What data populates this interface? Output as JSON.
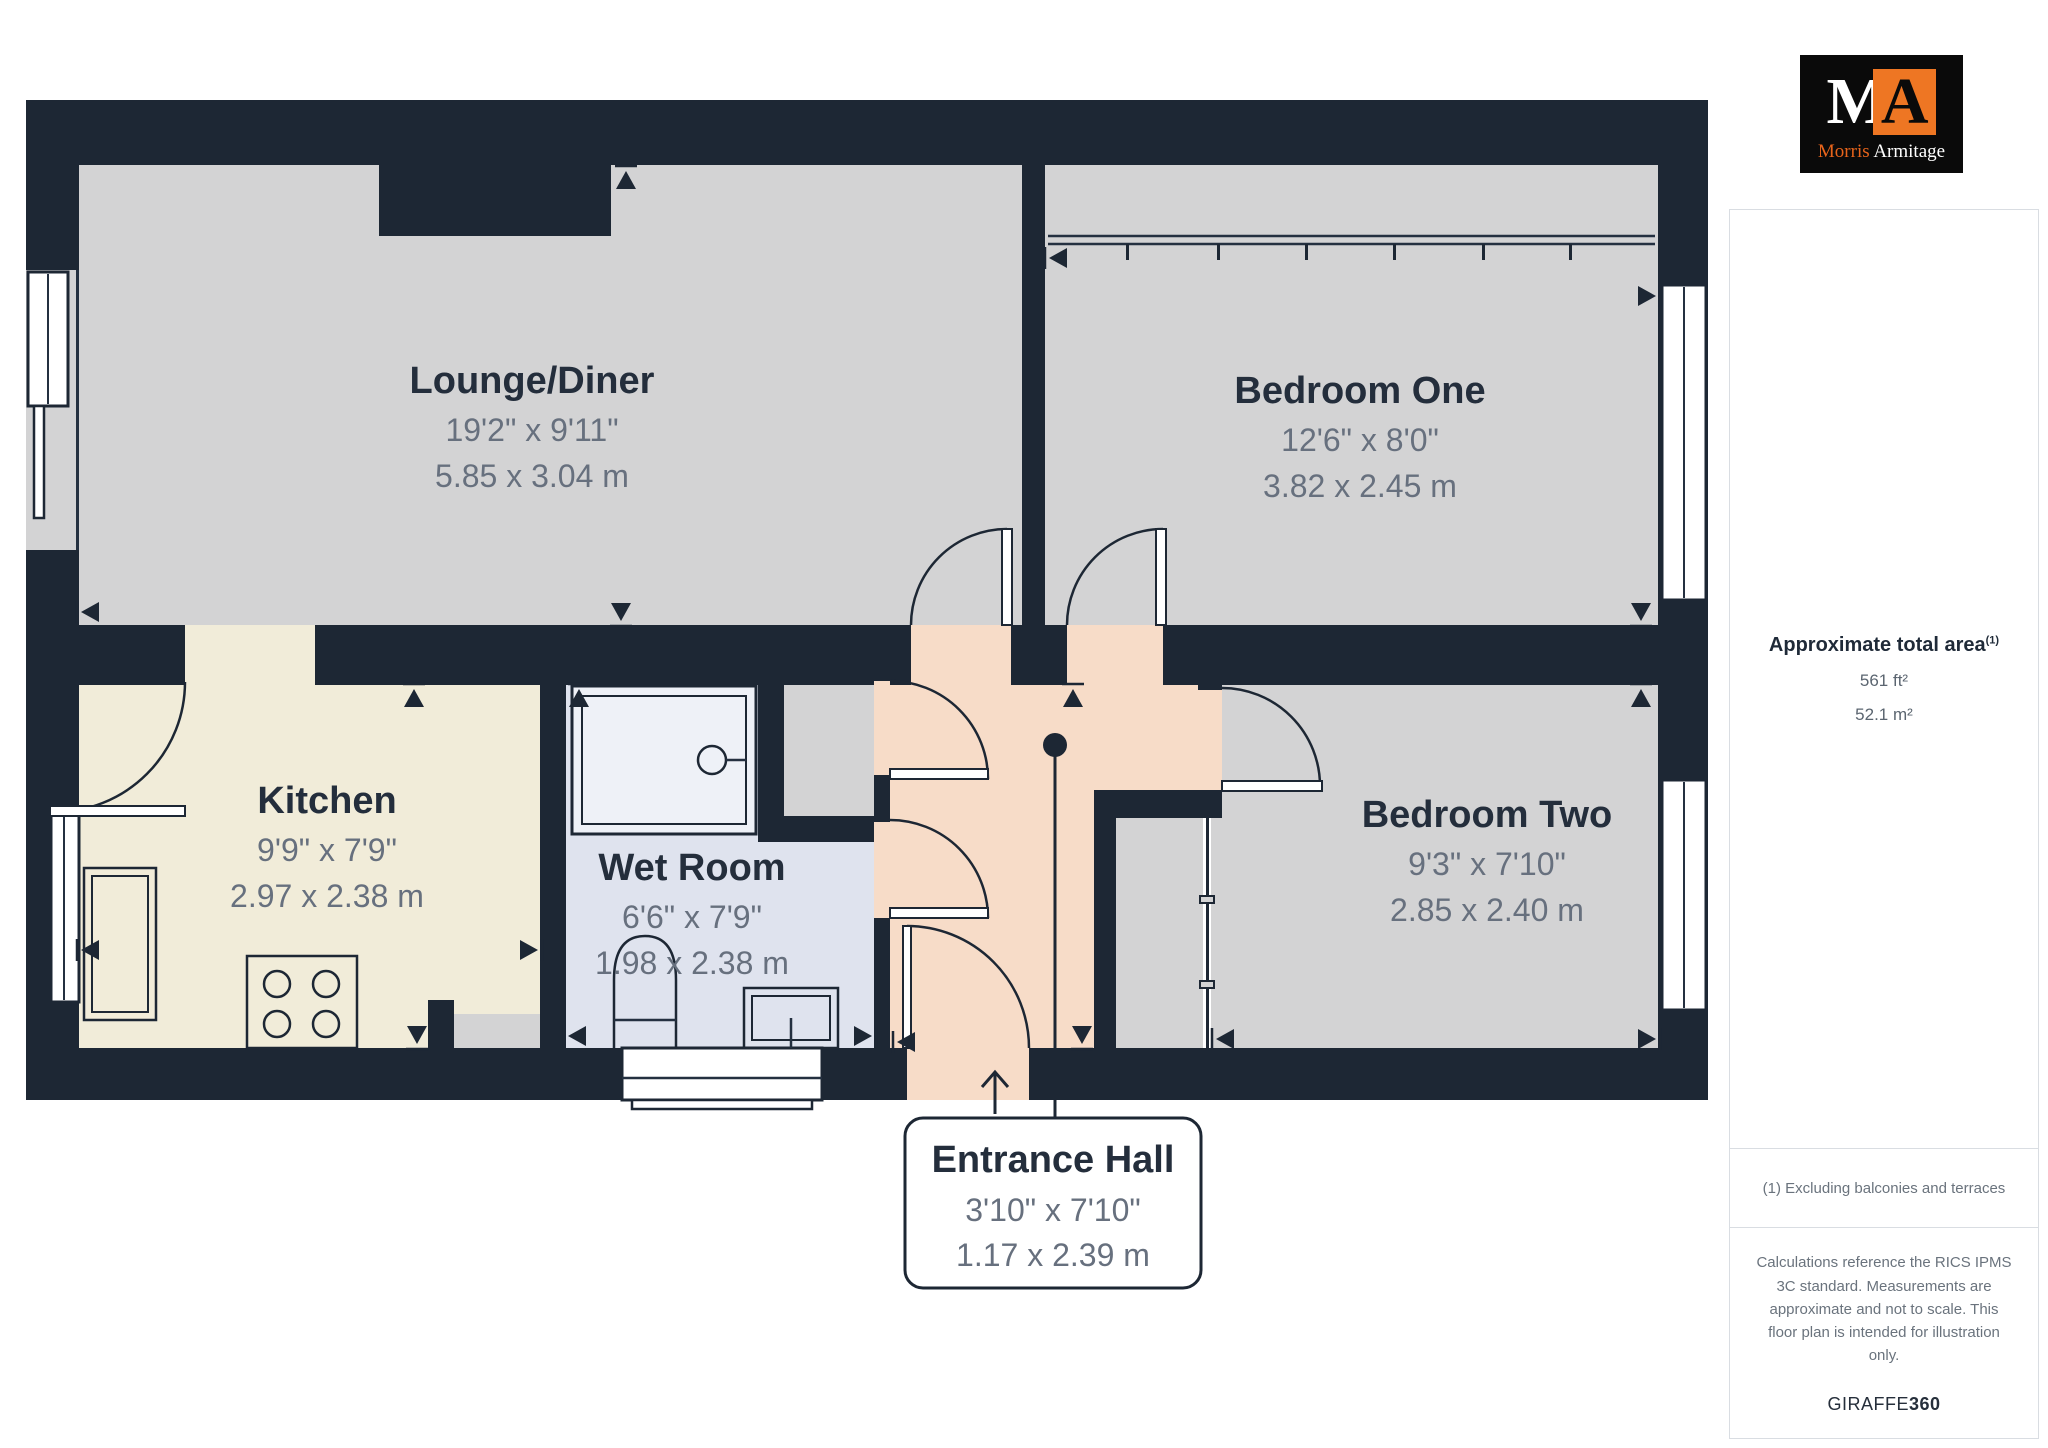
{
  "floorplan": {
    "rooms": [
      {
        "name": "Lounge/Diner",
        "imperial": "19'2\" x 9'11\"",
        "metric": "5.85 x 3.04 m"
      },
      {
        "name": "Bedroom One",
        "imperial": "12'6\" x 8'0\"",
        "metric": "3.82 x 2.45 m"
      },
      {
        "name": "Kitchen",
        "imperial": "9'9\" x 7'9\"",
        "metric": "2.97 x 2.38 m"
      },
      {
        "name": "Wet Room",
        "imperial": "6'6\" x 7'9\"",
        "metric": "1.98 x 2.38 m"
      },
      {
        "name": "Bedroom Two",
        "imperial": "9'3\" x 7'10\"",
        "metric": "2.85 x 2.40 m"
      },
      {
        "name": "Entrance Hall",
        "imperial": "3'10\" x 7'10\"",
        "metric": "1.17 x 2.39 m"
      }
    ],
    "colors": {
      "wall": "#1d2734",
      "room_floor": "#d3d3d4",
      "kitchen_floor": "#f1ecd9",
      "wetroom_floor": "#dfe3ee",
      "hall_floor": "#f7dcc8"
    }
  },
  "sidebar": {
    "logo": {
      "monogram_m": "M",
      "monogram_a": "A",
      "name_first": "Morris",
      "name_last": "Armitage",
      "accent_color": "#ee7623"
    },
    "area": {
      "title": "Approximate total area",
      "superscript": "(1)",
      "imperial": "561 ft²",
      "metric": "52.1 m²"
    },
    "footnote": "(1) Excluding balconies and terraces",
    "disclaimer": "Calculations reference the RICS IPMS 3C standard. Measurements are approximate and not to scale. This floor plan is intended for illustration only.",
    "brand": {
      "name": "GIRAFFE",
      "suffix": "360"
    }
  }
}
